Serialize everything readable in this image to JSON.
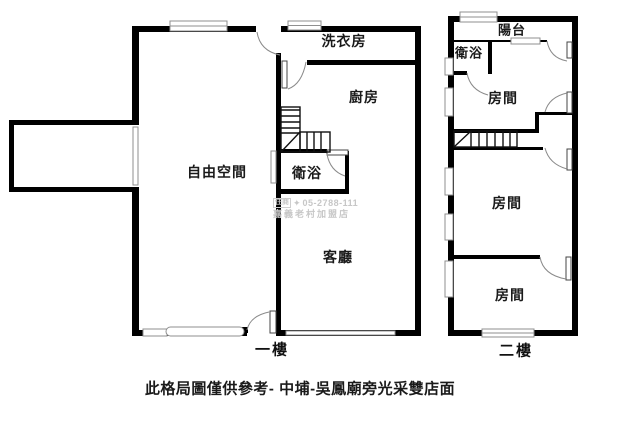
{
  "caption": "此格局圖僅供參考- 中埔-吳鳳廟旁光采雙店面",
  "floor1": {
    "name": "一樓",
    "rooms": {
      "laundry": "洗衣房",
      "kitchen": "廚房",
      "free_space": "自由空間",
      "bathroom": "衛浴",
      "living": "客廳"
    }
  },
  "floor2": {
    "name": "二樓",
    "rooms": {
      "balcony": "陽台",
      "bathroom": "衛浴",
      "room1": "房間",
      "room2": "房間",
      "room3": "房間"
    }
  },
  "watermark": {
    "brand": "住商",
    "phone": "05-2788-111",
    "store": "嘉義老村加盟店"
  },
  "icons": {
    "brand_logo": "✦"
  },
  "colors": {
    "background": "#ffffff",
    "wall": "#000000",
    "window_outline": "#8f8f8f",
    "door_arc": "#8a8a8a",
    "stairs": "#111111",
    "watermark": "#c7c7c7"
  }
}
